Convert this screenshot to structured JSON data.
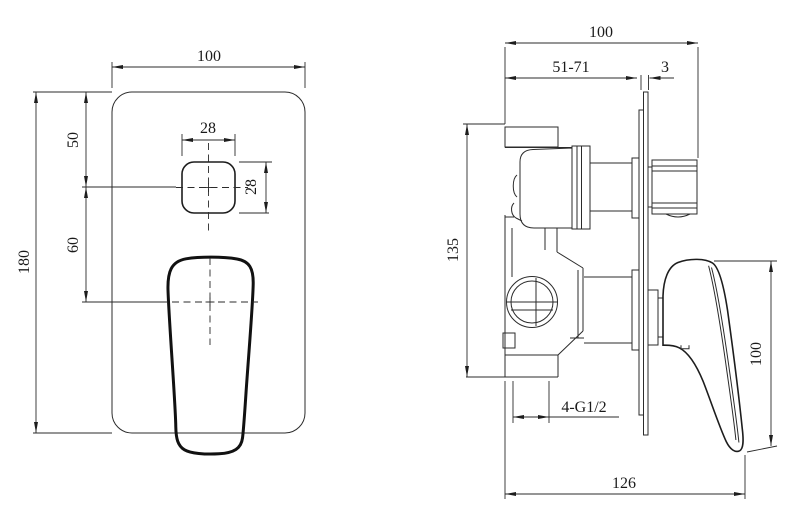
{
  "drawing": {
    "type": "technical-dimension-drawing",
    "subject": "concealed shower mixer valve, front and side views",
    "line_color": "#1d1d1d",
    "background": "#ffffff",
    "front_view": {
      "plate_width": "100",
      "plate_height": "180",
      "button_offset_from_top": "50",
      "button_to_handle_center": "60",
      "button_width": "28",
      "button_height": "28"
    },
    "side_view": {
      "overall_depth": "100",
      "installation_depth_range": "51-71",
      "plate_thickness": "3",
      "valve_body_height": "135",
      "handle_height": "100",
      "inlet_thread": "4-G1/2",
      "overall_projection": "126"
    }
  }
}
